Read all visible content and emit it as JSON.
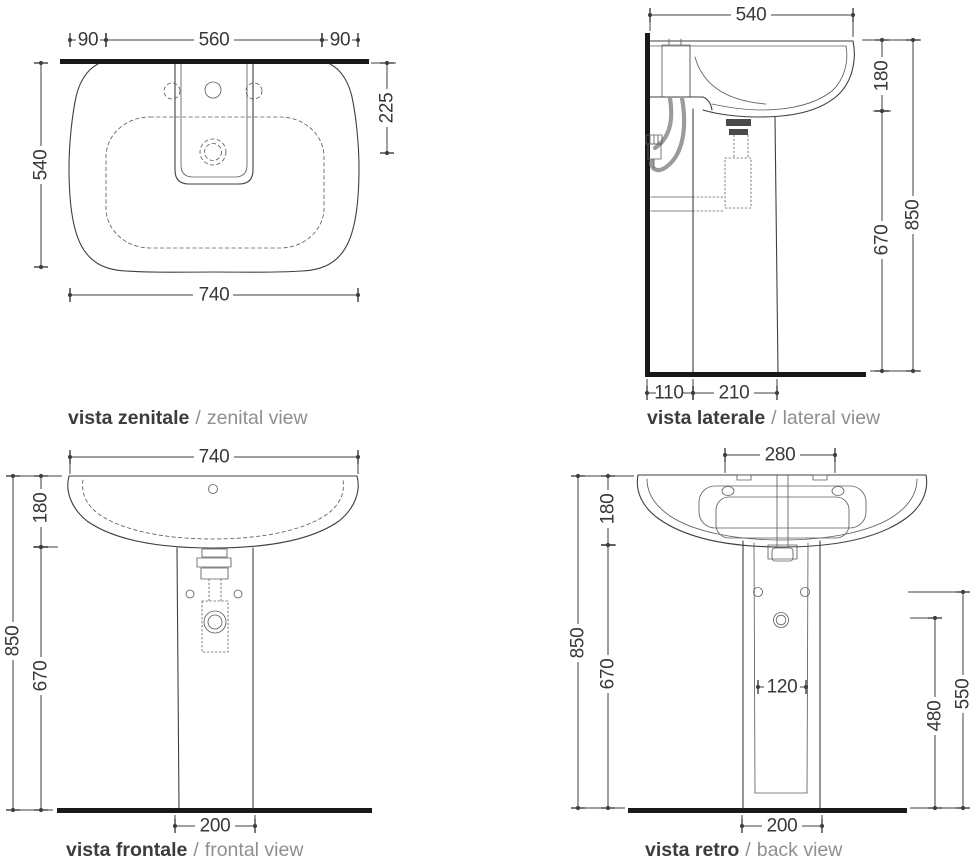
{
  "page": {
    "background": "#ffffff"
  },
  "colors": {
    "line": "#3f3f3f",
    "wall_floor": "#191919",
    "hose": "#9b9b9b",
    "dim_text": "#383838",
    "label_primary": "#3c3c3c",
    "label_secondary": "#8f8f8f"
  },
  "separator": "/",
  "views": {
    "zenital": {
      "title_it": "vista zenitale",
      "title_en": "zenital view",
      "dims": {
        "left_edge_to_tap": "90",
        "tap_span": "560",
        "tap_to_right_edge": "90",
        "total_depth": "540",
        "tap_depth": "225",
        "total_width": "740"
      }
    },
    "lateral": {
      "title_it": "vista laterale",
      "title_en": "lateral view",
      "dims": {
        "total_depth": "540",
        "basin_height": "180",
        "total_height": "850",
        "pedestal_height": "670",
        "wall_to_pedestal": "110",
        "pedestal_depth": "210"
      }
    },
    "frontal": {
      "title_it": "vista frontale",
      "title_en": "frontal view",
      "dims": {
        "total_width": "740",
        "basin_height": "180",
        "total_height": "850",
        "pedestal_height": "670",
        "pedestal_width": "200"
      }
    },
    "back": {
      "title_it": "vista retro",
      "title_en": "back view",
      "dims": {
        "fixing_holes_span": "280",
        "basin_height": "180",
        "total_height": "850",
        "pedestal_height": "670",
        "pedestal_inner_width": "120",
        "drain_outlet_height": "480",
        "fixing_holes_height": "550",
        "pedestal_width": "200"
      }
    }
  }
}
